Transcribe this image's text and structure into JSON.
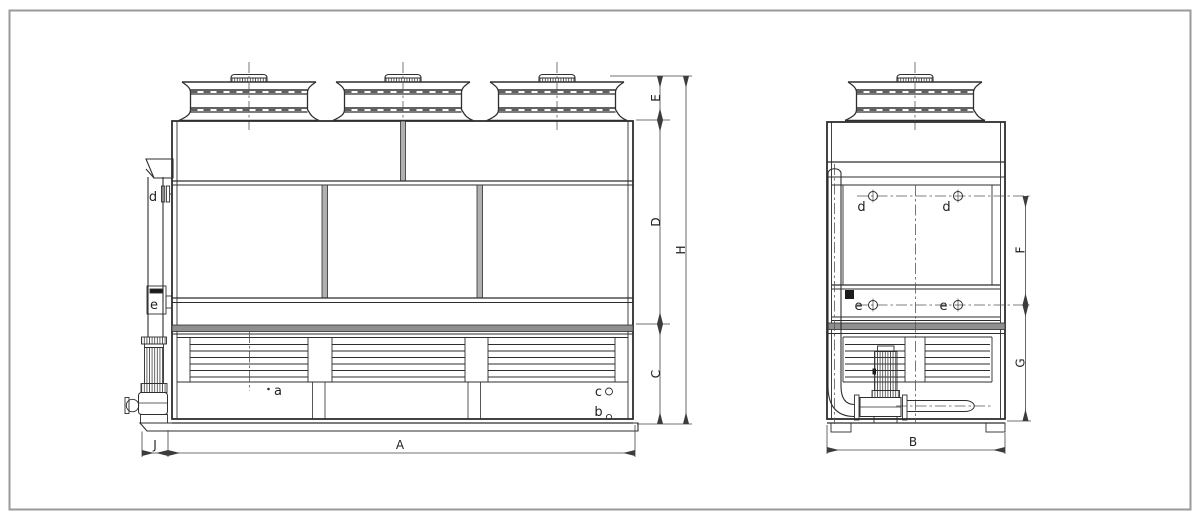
{
  "colors": {
    "line": "#2e2e2e",
    "thin": "#3c3c3c",
    "dim_line": "#444444",
    "centerline": "#555555",
    "band_fill": "#8f8f8f",
    "divider_fill": "#b0b0b0",
    "dark_fill": "#1c1c1c",
    "border": "#9a9a9a",
    "background": "#ffffff"
  },
  "front_view": {
    "dims": {
      "E": "E",
      "D": "D",
      "C": "C",
      "H": "H",
      "A": "A",
      "J": "J"
    },
    "ports": {
      "d": "d",
      "e": "e",
      "a": "a",
      "c": "c",
      "b": "b"
    }
  },
  "side_view": {
    "dims": {
      "F": "F",
      "G": "G",
      "B": "B"
    },
    "ports": {
      "d1": "d",
      "d2": "d",
      "e1": "e",
      "e2": "e"
    }
  }
}
